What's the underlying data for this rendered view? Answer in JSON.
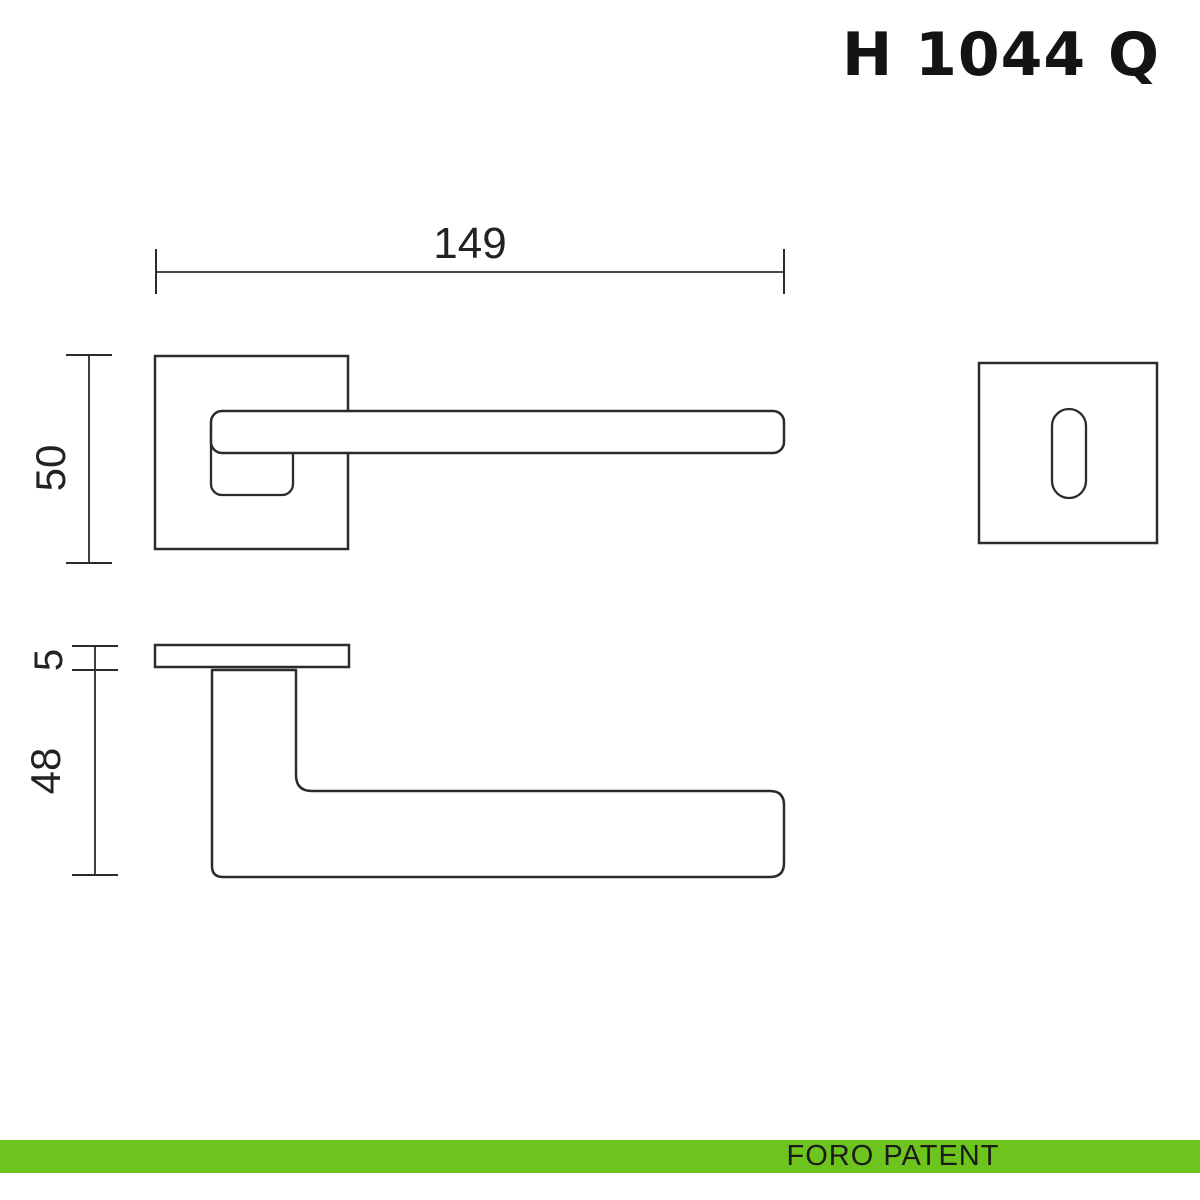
{
  "title": "H 1044 Q",
  "drawing": {
    "dimensions": {
      "overall_length": "149",
      "rose_size": "50",
      "rose_thickness": "5",
      "handle_projection": "48"
    }
  },
  "footer": {
    "label": "FORO PATENT"
  },
  "colors": {
    "line": "#2b2b2b",
    "accent_green": "#6cc41c",
    "footer_text": "#1b1b1b",
    "background": "#ffffff"
  }
}
